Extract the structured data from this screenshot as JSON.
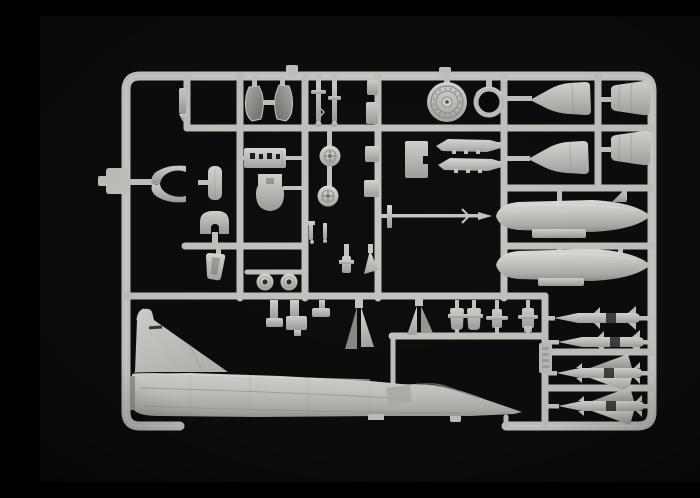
{
  "photo": {
    "subject": "Photograph of a light grey injection-moulded plastic model kit sprue (Mirage 2000 style aircraft parts) on a black background",
    "background_color": "#0b0b0b",
    "plastic_color": "#c8c8c4",
    "plastic_highlight": "#e2e2de",
    "plastic_shadow": "#8f8f8b"
  },
  "parts": [
    {
      "name": "sprue-frame",
      "label": "rounded rectangular runner frame"
    },
    {
      "name": "fuselage-half",
      "label": "aircraft fuselage half with tall swept tail fin"
    },
    {
      "name": "drop-tank-1",
      "label": "large external fuel drop tank"
    },
    {
      "name": "drop-tank-2",
      "label": "second external fuel drop tank"
    },
    {
      "name": "radome-half-1",
      "label": "pointed nose radome half"
    },
    {
      "name": "radome-half-2",
      "label": "pointed nose radome half"
    },
    {
      "name": "exhaust-nozzle-1",
      "label": "engine exhaust can half"
    },
    {
      "name": "exhaust-nozzle-2",
      "label": "engine exhaust can half"
    },
    {
      "name": "wheel-hub-large",
      "label": "large detailed wheel hub disc"
    },
    {
      "name": "tire-ring",
      "label": "open tire ring"
    },
    {
      "name": "nose-wheel",
      "label": "small spoked wheel"
    },
    {
      "name": "main-wheel",
      "label": "small spoked wheel"
    },
    {
      "name": "landing-gear-struts",
      "label": "pair of landing gear legs"
    },
    {
      "name": "gear-door-left",
      "label": "curved gear door"
    },
    {
      "name": "gear-door-right",
      "label": "curved gear door"
    },
    {
      "name": "equipment-panel",
      "label": "slotted equipment panel"
    },
    {
      "name": "ejection-seat",
      "label": "ejection seat part"
    },
    {
      "name": "intake-lip-pair",
      "label": "curved intake lip parts"
    },
    {
      "name": "canopy-section",
      "label": "rounded canopy section"
    },
    {
      "name": "seat-frame",
      "label": "horseshoe shaped frame part"
    },
    {
      "name": "missile-rail-1",
      "label": "missile launch rail"
    },
    {
      "name": "missile-rail-2",
      "label": "missile launch rail"
    },
    {
      "name": "gear-bay-box",
      "label": "stepped bay box"
    },
    {
      "name": "pitot-probe",
      "label": "long pitot probe with tee head"
    },
    {
      "name": "hub-disc-1",
      "label": "round hub disc"
    },
    {
      "name": "hub-disc-2",
      "label": "round hub disc"
    },
    {
      "name": "windscreen",
      "label": "trapezoid windscreen piece"
    },
    {
      "name": "ventral-fin-pair-a",
      "label": "pair of small triangular fins"
    },
    {
      "name": "ventral-fin-pair-b",
      "label": "pair of small triangular fins"
    },
    {
      "name": "pylon-row",
      "label": "row of four weapon pylons"
    },
    {
      "name": "missile-slim-1",
      "label": "slender air-to-air missile"
    },
    {
      "name": "missile-slim-2",
      "label": "slender air-to-air missile"
    },
    {
      "name": "missile-delta-1",
      "label": "delta winged missile"
    },
    {
      "name": "missile-delta-2",
      "label": "delta winged missile"
    },
    {
      "name": "sprue-id-tag",
      "label": "embossed sprue number tag"
    },
    {
      "name": "small-parts-cluster",
      "label": "assorted small detail parts"
    }
  ]
}
